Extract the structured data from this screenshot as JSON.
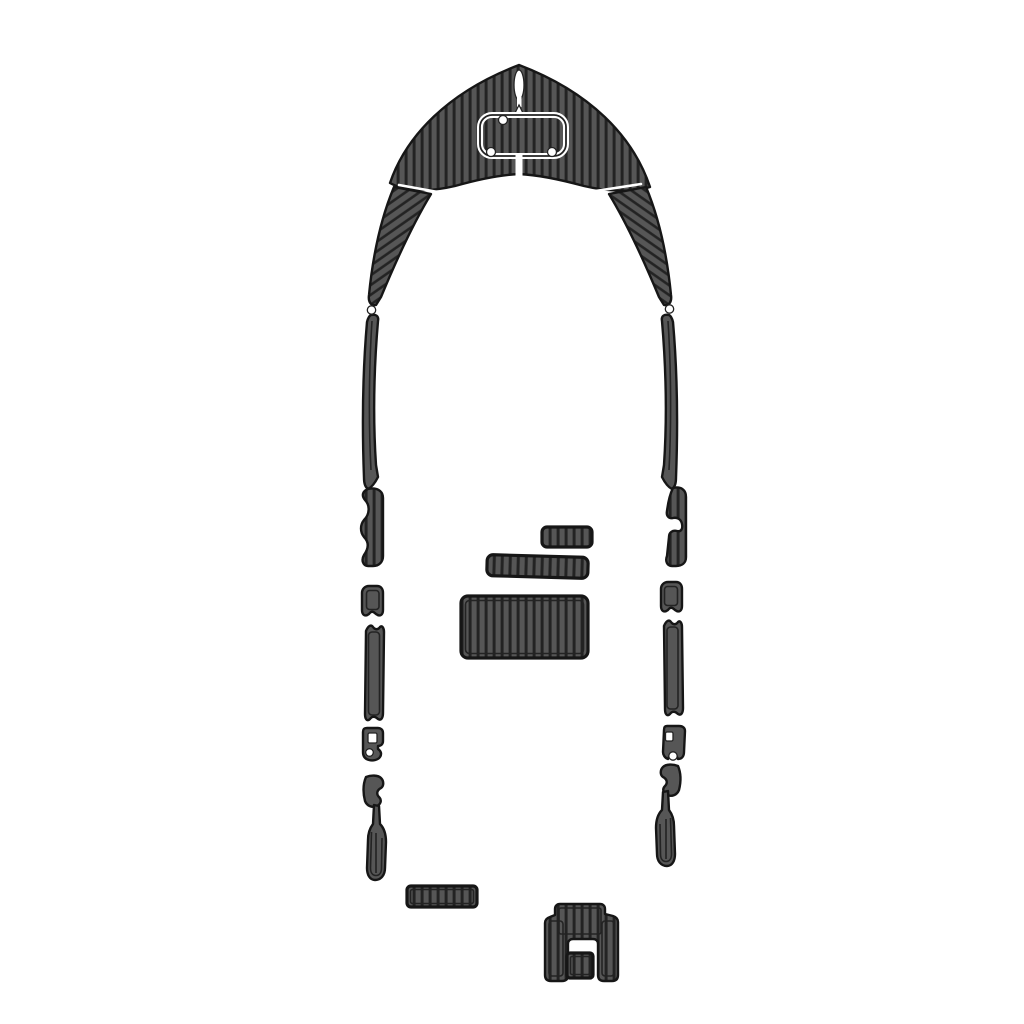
{
  "canvas": {
    "width": 1024,
    "height": 1024
  },
  "colors": {
    "background": "#ffffff",
    "pad": "#565656",
    "stripe": "#232323",
    "outline": "#161616",
    "cutout": "#ffffff"
  },
  "diagram": {
    "name": "boat-eva-foam-decking-pad-layout"
  },
  "pieces": [
    {
      "name": "bow-v-pad"
    },
    {
      "name": "port-gunwale-upper-pad"
    },
    {
      "name": "starboard-gunwale-upper-pad"
    },
    {
      "name": "port-gunwale-lower-strip"
    },
    {
      "name": "starboard-gunwale-lower-strip"
    },
    {
      "name": "port-scallop-pad"
    },
    {
      "name": "starboard-scallop-pad"
    },
    {
      "name": "port-side-strip-short"
    },
    {
      "name": "port-side-strip-long"
    },
    {
      "name": "starboard-side-strip-short"
    },
    {
      "name": "starboard-side-strip-long"
    },
    {
      "name": "port-cleat-bracket-pad"
    },
    {
      "name": "starboard-cleat-bracket-pad"
    },
    {
      "name": "port-hook-pad"
    },
    {
      "name": "starboard-hook-pad"
    },
    {
      "name": "port-paddle-pad"
    },
    {
      "name": "starboard-paddle-pad"
    },
    {
      "name": "step-pad-small"
    },
    {
      "name": "step-pad-medium"
    },
    {
      "name": "cockpit-pad-large"
    },
    {
      "name": "stern-bar-pad"
    },
    {
      "name": "transom-bracket-pad"
    },
    {
      "name": "transom-insert-pad"
    }
  ]
}
